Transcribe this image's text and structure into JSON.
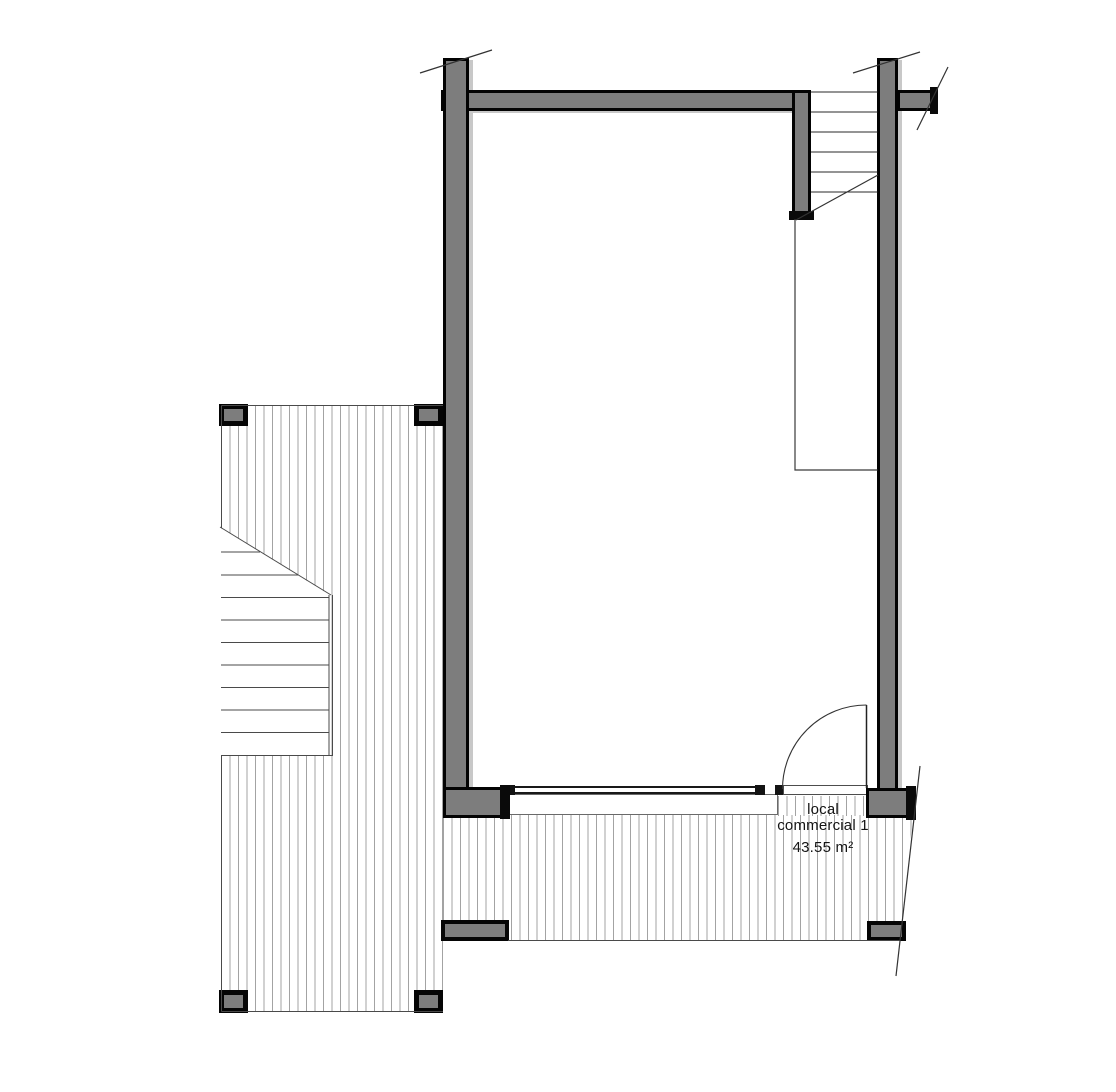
{
  "plan": {
    "title": "commercial unit floor plan",
    "room": {
      "name_lines": [
        "local",
        "commercial 1"
      ],
      "area_label": "43.55 m²"
    },
    "colors": {
      "wall_fill": "#7d7d7d",
      "wall_edge": "#030303",
      "wall_inner_strip": "#c8c8c8",
      "hatch_line": "#a3a3a3",
      "thin_line": "#4a4a4a",
      "cut_line": "#333333",
      "text": "#141414",
      "background": "#ffffff"
    }
  }
}
